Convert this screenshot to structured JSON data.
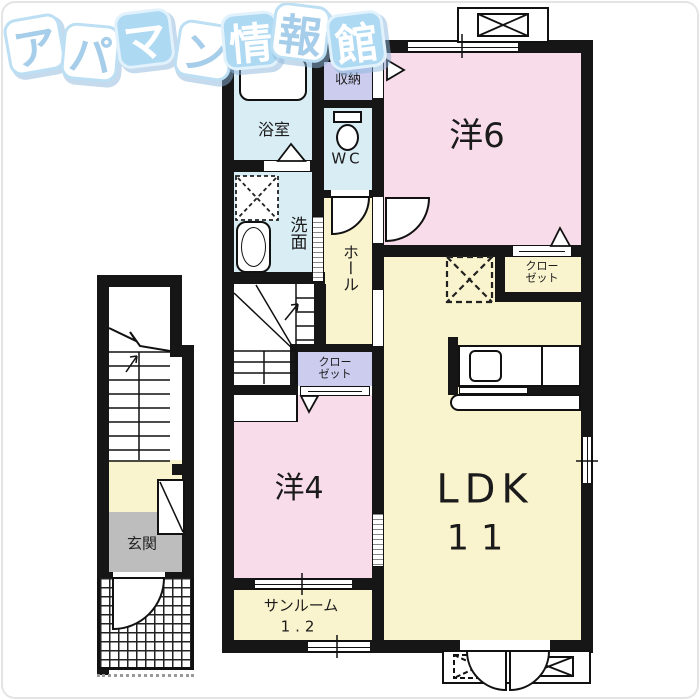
{
  "logo": {
    "title": "アパマン情報館",
    "chars": [
      {
        "ch": "ア"
      },
      {
        "ch": "パ"
      },
      {
        "ch": "マ"
      },
      {
        "ch": "ン"
      },
      {
        "ch": "情"
      },
      {
        "ch": "報"
      },
      {
        "ch": "館"
      }
    ]
  },
  "rooms": {
    "bathroom": {
      "label": "浴室"
    },
    "storage": {
      "label": "収納"
    },
    "toilet": {
      "label": "WC"
    },
    "washroom": {
      "label": "洗面"
    },
    "hall": {
      "label": "ホール"
    },
    "closet_hall": {
      "label_line1": "クロー",
      "label_line2": "ゼット"
    },
    "closet_bedroom6": {
      "label_line1": "クロー",
      "label_line2": "ゼット"
    },
    "bedroom6": {
      "label": "洋6"
    },
    "bedroom4": {
      "label": "洋4"
    },
    "ldk": {
      "label": "LDK",
      "size_label": "11"
    },
    "sunroom": {
      "label": "サンルーム",
      "size_label": "1.2"
    },
    "entrance": {
      "label": "玄関"
    }
  },
  "colors": {
    "wall": "#161616",
    "room_pink": "#F9DCE9",
    "room_cream": "#FAF4CE",
    "room_blue": "#D9EDF5",
    "room_lavender": "#CBCCEE",
    "entrance_gray": "#BDBDBD",
    "logo_tile_blue": "#AED9F3",
    "logo_text_blue": "#A6CDE9"
  }
}
